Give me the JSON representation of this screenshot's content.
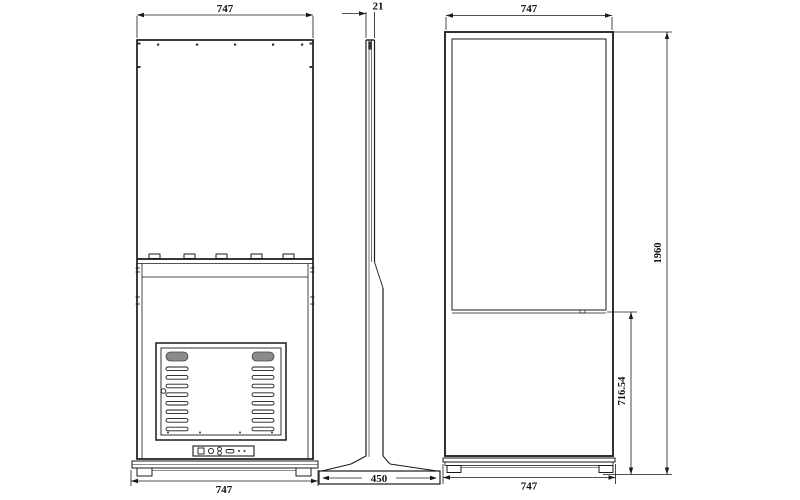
{
  "dimensions": {
    "back_view": {
      "width_top": "747",
      "width_bottom": "747"
    },
    "side_view": {
      "thickness": "21",
      "base_depth": "450"
    },
    "front_view": {
      "width_top": "747",
      "width_bottom": "747",
      "overall_height": "1960",
      "lower_section_height": "716.54"
    }
  }
}
